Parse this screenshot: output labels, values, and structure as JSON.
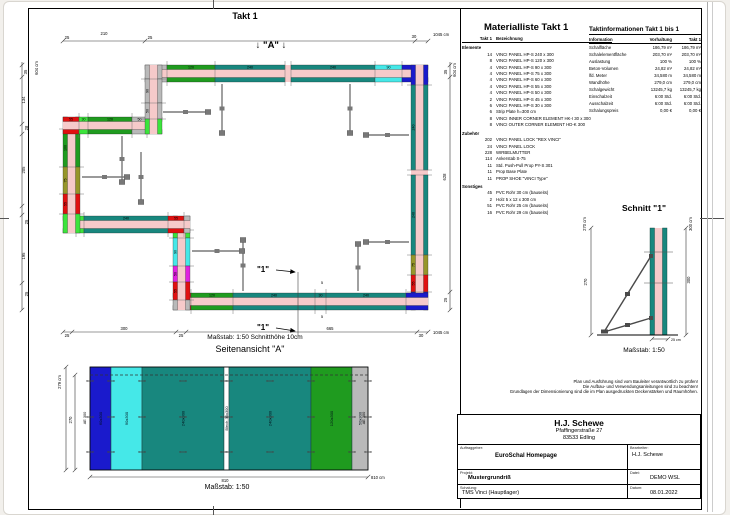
{
  "colors": {
    "teal": "#18877e",
    "green": "#1f9b1f",
    "lime": "#3ce43c",
    "cyan": "#45e8e8",
    "blue": "#1a1acc",
    "red": "#e01010",
    "magenta": "#e020e0",
    "olive": "#96962a",
    "gray": "#b9b9b9",
    "pink": "#f6caca",
    "prop": "#787878",
    "white": "#ffffff"
  },
  "plan": {
    "title": "Takt 1",
    "a_marker": "↓ \"A\" ↓",
    "scale_note": "Maßstab: 1:50   Schnitthöhe 10cm",
    "walls": [
      {
        "dir": "h",
        "x": 145,
        "y": 65,
        "len": 283,
        "segs": [
          {
            "c": "gray",
            "l": 22,
            "t": "30"
          },
          {
            "c": "green",
            "l": 48,
            "t": "120"
          },
          {
            "c": "teal",
            "l": 70,
            "t": "240"
          },
          {
            "c": "gap",
            "l": 6
          },
          {
            "c": "teal",
            "l": 84,
            "t": "240"
          },
          {
            "c": "cyan",
            "l": 27,
            "t": "90"
          },
          {
            "c": "blue",
            "l": 26
          }
        ]
      },
      {
        "dir": "v",
        "x": 411,
        "y": 65,
        "len": 245,
        "segs": [
          {
            "c": "blue",
            "l": 20
          },
          {
            "c": "teal",
            "l": 85,
            "t": "240"
          },
          {
            "c": "gap",
            "l": 5
          },
          {
            "c": "teal",
            "l": 80,
            "t": "240"
          },
          {
            "c": "olive",
            "l": 20,
            "t": "75"
          },
          {
            "c": "red",
            "l": 17,
            "t": "55"
          },
          {
            "c": "blue",
            "l": 18
          }
        ]
      },
      {
        "dir": "h",
        "x": 173,
        "y": 293,
        "len": 255,
        "segs": [
          {
            "c": "red",
            "l": 18,
            "t": "55"
          },
          {
            "c": "green",
            "l": 42,
            "t": "120"
          },
          {
            "c": "teal",
            "l": 82,
            "t": "240"
          },
          {
            "c": "teal",
            "l": 11,
            "t": "30"
          },
          {
            "c": "teal",
            "l": 80,
            "t": "240"
          },
          {
            "c": "blue",
            "l": 22
          }
        ]
      },
      {
        "dir": "v",
        "x": 173,
        "y": 216,
        "len": 94,
        "segs": [
          {
            "c": "red",
            "l": 14,
            "t": "55"
          },
          {
            "c": "lime",
            "l": 8
          },
          {
            "c": "cyan",
            "l": 28,
            "t": "90"
          },
          {
            "c": "magenta",
            "l": 16,
            "t": "50"
          },
          {
            "c": "red",
            "l": 18,
            "t": "55"
          },
          {
            "c": "gray",
            "l": 10
          }
        ]
      },
      {
        "dir": "h",
        "x": 63,
        "y": 216,
        "len": 127,
        "segs": [
          {
            "c": "red",
            "l": 13,
            "t": "55"
          },
          {
            "c": "lime",
            "l": 8
          },
          {
            "c": "teal",
            "l": 84,
            "t": "240"
          },
          {
            "c": "red",
            "l": 16,
            "t": "55"
          },
          {
            "c": "gray",
            "l": 6
          }
        ]
      },
      {
        "dir": "v",
        "x": 63,
        "y": 117,
        "len": 116,
        "segs": [
          {
            "c": "gray",
            "l": 12
          },
          {
            "c": "green",
            "l": 38,
            "t": "100"
          },
          {
            "c": "olive",
            "l": 27,
            "t": "75"
          },
          {
            "c": "red",
            "l": 20,
            "t": "55"
          },
          {
            "c": "lime",
            "l": 19
          }
        ]
      },
      {
        "dir": "h",
        "x": 63,
        "y": 117,
        "len": 99,
        "segs": [
          {
            "c": "red",
            "l": 16,
            "t": "55"
          },
          {
            "c": "lime",
            "l": 9,
            "t": "30"
          },
          {
            "c": "green",
            "l": 44,
            "t": "120"
          },
          {
            "c": "gray",
            "l": 15,
            "t": "50"
          },
          {
            "c": "gray",
            "l": 15
          }
        ]
      },
      {
        "dir": "v",
        "x": 145,
        "y": 65,
        "len": 69,
        "segs": [
          {
            "c": "gray",
            "l": 14
          },
          {
            "c": "gray",
            "l": 24,
            "t": "90"
          },
          {
            "c": "gray",
            "l": 16,
            "t": "50"
          },
          {
            "c": "lime",
            "l": 15
          }
        ]
      }
    ],
    "props": [
      {
        "x1": 222,
        "y1": 84,
        "x2": 222,
        "y2": 133
      },
      {
        "x1": 163,
        "y1": 112,
        "x2": 208,
        "y2": 112
      },
      {
        "x1": 350,
        "y1": 84,
        "x2": 350,
        "y2": 133
      },
      {
        "x1": 409,
        "y1": 135,
        "x2": 366,
        "y2": 135
      },
      {
        "x1": 82,
        "y1": 177,
        "x2": 127,
        "y2": 177
      },
      {
        "x1": 122,
        "y1": 136,
        "x2": 122,
        "y2": 182
      },
      {
        "x1": 141,
        "y1": 152,
        "x2": 141,
        "y2": 202
      },
      {
        "x1": 243,
        "y1": 291,
        "x2": 243,
        "y2": 240
      },
      {
        "x1": 192,
        "y1": 251,
        "x2": 242,
        "y2": 251
      },
      {
        "x1": 358,
        "y1": 291,
        "x2": 358,
        "y2": 244
      },
      {
        "x1": 409,
        "y1": 242,
        "x2": 366,
        "y2": 242
      }
    ],
    "texts": [
      {
        "x": 263,
        "y": 272,
        "t": "\"1\"",
        "s": 8,
        "b": 1
      },
      {
        "x": 263,
        "y": 330,
        "t": "\"1\"",
        "s": 8,
        "b": 1
      },
      {
        "x": 322,
        "y": 284,
        "t": "5",
        "s": 4
      },
      {
        "x": 322,
        "y": 318,
        "t": "5",
        "s": 4
      }
    ],
    "arrows": [
      {
        "x1": 276,
        "y1": 270,
        "x2": 295,
        "y2": 272
      },
      {
        "x1": 276,
        "y1": 328,
        "x2": 295,
        "y2": 331
      }
    ],
    "lines": [
      {
        "x1": 298,
        "y1": 272,
        "x2": 298,
        "y2": 336
      }
    ]
  },
  "dims": [
    {
      "l": [
        63,
        41,
        428,
        41
      ],
      "ticks": [
        [
          63,
          41
        ],
        [
          145,
          41
        ],
        [
          415,
          41
        ],
        [
          428,
          41
        ]
      ],
      "labels": [
        {
          "x": 67,
          "y": 39,
          "t": "25"
        },
        {
          "x": 104,
          "y": 35,
          "t": "210"
        },
        {
          "x": 150,
          "y": 39,
          "t": "25"
        },
        {
          "x": 414,
          "y": 38,
          "t": "30"
        },
        {
          "x": 433,
          "y": 36,
          "t": "1045 cm",
          "a": "start"
        }
      ]
    },
    {
      "l": [
        22,
        62,
        22,
        310
      ],
      "ticks": [
        [
          22,
          65
        ],
        [
          22,
          77
        ],
        [
          22,
          124
        ],
        [
          22,
          134
        ],
        [
          22,
          206
        ],
        [
          22,
          215
        ],
        [
          22,
          283
        ],
        [
          22,
          310
        ]
      ],
      "labels": [
        {
          "x": 38,
          "y": 68,
          "t": "604 cm",
          "r": 1
        },
        {
          "x": 27,
          "y": 72,
          "t": "35",
          "r": 1
        },
        {
          "x": 25,
          "y": 100,
          "t": "134",
          "r": 1
        },
        {
          "x": 28,
          "y": 128,
          "t": "28",
          "r": 1
        },
        {
          "x": 25,
          "y": 170,
          "t": "205",
          "r": 1
        },
        {
          "x": 28,
          "y": 222,
          "t": "25",
          "r": 1
        },
        {
          "x": 25,
          "y": 256,
          "t": "195",
          "r": 1
        },
        {
          "x": 28,
          "y": 294,
          "t": "25",
          "r": 1
        }
      ]
    },
    {
      "l": [
        450,
        62,
        450,
        310
      ],
      "ticks": [
        [
          450,
          65
        ],
        [
          450,
          77
        ],
        [
          450,
          292
        ],
        [
          450,
          310
        ]
      ],
      "labels": [
        {
          "x": 456,
          "y": 70,
          "t": "604 cm",
          "r": 1
        },
        {
          "x": 447,
          "y": 72,
          "t": "35",
          "r": 1
        },
        {
          "x": 446,
          "y": 177,
          "t": "628",
          "r": 1
        },
        {
          "x": 447,
          "y": 300,
          "t": "25",
          "r": 1
        }
      ]
    },
    {
      "l": [
        63,
        332,
        428,
        332
      ],
      "ticks": [
        [
          63,
          332
        ],
        [
          72,
          332
        ],
        [
          176,
          332
        ],
        [
          186,
          332
        ],
        [
          417,
          332
        ],
        [
          428,
          332
        ]
      ],
      "labels": [
        {
          "x": 67,
          "y": 337,
          "t": "25"
        },
        {
          "x": 124,
          "y": 330,
          "t": "300"
        },
        {
          "x": 181,
          "y": 337,
          "t": "25"
        },
        {
          "x": 330,
          "y": 330,
          "t": "665"
        },
        {
          "x": 421,
          "y": 337,
          "t": "30"
        },
        {
          "x": 433,
          "y": 334,
          "t": "1045 cm",
          "a": "start"
        }
      ]
    },
    {
      "l": [
        66,
        367,
        66,
        470
      ],
      "ticks": [
        [
          66,
          367
        ],
        [
          66,
          470
        ]
      ],
      "labels": [
        {
          "x": 61,
          "y": 382,
          "t": "279 cm",
          "r": 1
        }
      ]
    },
    {
      "l": [
        75,
        375,
        75,
        470
      ],
      "ticks": [
        [
          75,
          375
        ],
        [
          75,
          470
        ]
      ],
      "labels": [
        {
          "x": 72,
          "y": 420,
          "t": "270",
          "r": 1
        }
      ]
    },
    {
      "l": [
        90,
        477,
        368,
        477
      ],
      "ticks": [
        [
          90,
          477
        ],
        [
          368,
          477
        ]
      ],
      "labels": [
        {
          "x": 225,
          "y": 482,
          "t": "810"
        },
        {
          "x": 371,
          "y": 479,
          "t": "810 cm",
          "a": "start"
        }
      ]
    },
    {
      "l": [
        591,
        228,
        591,
        335
      ],
      "ticks": [
        [
          591,
          228
        ],
        [
          591,
          335
        ]
      ],
      "labels": [
        {
          "x": 586,
          "y": 224,
          "t": "270 cm",
          "r": 1
        },
        {
          "x": 587,
          "y": 282,
          "t": "270",
          "r": 1
        }
      ]
    },
    {
      "l": [
        686,
        228,
        686,
        335
      ],
      "ticks": [
        [
          686,
          228
        ],
        [
          686,
          335
        ]
      ],
      "labels": [
        {
          "x": 692,
          "y": 224,
          "t": "300 cm",
          "r": 1
        },
        {
          "x": 690,
          "y": 280,
          "t": "300",
          "r": 1
        }
      ]
    },
    {
      "l": [
        652,
        339,
        668,
        339
      ],
      "ticks": [
        [
          652,
          339
        ],
        [
          668,
          339
        ]
      ],
      "labels": [
        {
          "x": 671,
          "y": 341,
          "t": "25 cm",
          "a": "start",
          "s": 3.6
        }
      ]
    }
  ],
  "side_view": {
    "title": "Seitenansicht \"A\"",
    "scale": "Maßstab: 1:50",
    "x": 90,
    "y": 367,
    "h": 103,
    "dash_y": 375,
    "tie_rows": [
      381,
      417,
      452
    ],
    "panels": [
      {
        "w": 21,
        "c": "blue",
        "label": "60x300"
      },
      {
        "w": 31,
        "c": "cyan",
        "label": "90x300"
      },
      {
        "w": 82,
        "c": "teal",
        "label": "240x300"
      },
      {
        "w": 5,
        "c": "white",
        "label": "Blech 30x300"
      },
      {
        "w": 82,
        "c": "teal",
        "label": "240x300"
      },
      {
        "w": 41,
        "c": "green",
        "label": "120x300"
      },
      {
        "w": 16,
        "c": "gray",
        "label": "50x300"
      }
    ],
    "edge_labels": [
      {
        "x": 86,
        "y": 418,
        "t": "AE 300"
      },
      {
        "x": 365,
        "y": 418,
        "t": "AE 300"
      }
    ]
  },
  "schnitt": {
    "title": "Schnitt \"1\"",
    "scale": "Maßstab: 1:50",
    "wall": {
      "x": 650,
      "y": 228,
      "h": 107,
      "panel_w": 4.5,
      "core_w": 8
    },
    "ties_y": [
      252,
      283
    ],
    "ground": {
      "x1": 597,
      "y1": 335,
      "x2": 678,
      "y2": 335
    },
    "props": [
      {
        "x1": 651,
        "y1": 256,
        "x2": 604,
        "y2": 332
      },
      {
        "x1": 651,
        "y1": 318,
        "x2": 604,
        "y2": 332
      }
    ]
  },
  "material_list": {
    "title": "Materialliste  Takt 1",
    "col_qty": "Takt 1",
    "col_name": "Bezeichnung",
    "sections": [
      {
        "name": "Elemente",
        "items": [
          {
            "qty": "14",
            "name": "VINCI PANEL HP-S 240 x 300"
          },
          {
            "qty": "8",
            "name": "VINCI PANEL HP-S 120 x 300"
          },
          {
            "qty": "4",
            "name": "VINCI PANEL HP-S 90 x 300"
          },
          {
            "qty": "4",
            "name": "VINCI PANEL HP-S 75 x 300"
          },
          {
            "qty": "4",
            "name": "VINCI PANEL HP-S 60 x 300"
          },
          {
            "qty": "4",
            "name": "VINCI PANEL HP-S 55 x 300"
          },
          {
            "qty": "4",
            "name": "VINCI PANEL HP-S 50 x 300"
          },
          {
            "qty": "2",
            "name": "VINCI PANEL HP-S 45 x 300"
          },
          {
            "qty": "6",
            "name": "VINCI PANEL HP-S 30 x 300"
          },
          {
            "qty": "6",
            "name": "Strip Plate h=300 cm"
          },
          {
            "qty": "8",
            "name": "VINCI INNER CORNER ELEMENT HK-I 30 x 300"
          },
          {
            "qty": "8",
            "name": "VINCI OUTER CORNER ELEMENT HD-K 300"
          }
        ]
      },
      {
        "name": "Zubehör",
        "items": [
          {
            "qty": "202",
            "name": "VINCI PANEL LOCK \"REX VINCI\""
          },
          {
            "qty": "24",
            "name": "VINCI PANEL LOCK"
          },
          {
            "qty": "228",
            "name": "WIRBELMUTTER"
          },
          {
            "qty": "114",
            "name": "Ankerstab S-75"
          },
          {
            "qty": "11",
            "name": "Std. Push-Pull Prop PY-S 301"
          },
          {
            "qty": "11",
            "name": "Prop Base Plate"
          },
          {
            "qty": "11",
            "name": "PROP SHOE \"VINCI Type\""
          }
        ]
      },
      {
        "name": "Sonstiges",
        "items": [
          {
            "qty": "45",
            "name": "PVC Rohr 30 cm (bauseits)"
          },
          {
            "qty": "2",
            "name": "Holz 5 x 12 x 300 cm"
          },
          {
            "qty": "51",
            "name": "PVC Rohr 25 cm (bauseits)"
          },
          {
            "qty": "16",
            "name": "PVC Rohr 29 cm (bauseits)"
          }
        ]
      }
    ]
  },
  "takt_info": {
    "title": "Taktinformationen  Takt 1 bis 1",
    "columns": [
      "Information",
      "Vorhaltung",
      "Takt 1"
    ],
    "rows": [
      [
        "Schalfläche",
        "186,79 m²",
        "186,79 m²"
      ],
      [
        "Schalelementfläche",
        "203,70 m²",
        "203,70 m²"
      ],
      [
        "Auslastung",
        "100 %",
        "100 %"
      ],
      [
        "Beton-Volumen",
        "24,82 m³",
        "24,82 m³"
      ],
      [
        "lfd. Meter",
        "34,580 m",
        "34,580 m"
      ],
      [
        "Wandhöhe",
        "279,0 cm",
        "279,0 cm"
      ],
      [
        "Schalgewicht",
        "13245,7 kg",
        "13245,7 kg"
      ],
      [
        "Einschalzeit",
        "6:00 Std.",
        "6:00 Std."
      ],
      [
        "Ausschalzeit",
        "6:00 Std.",
        "6:00 Std."
      ],
      [
        "Schalungspreis",
        "0,00 €",
        "0,00 €"
      ]
    ]
  },
  "disclaimer_lines": [
    "Plan und Ausführung sind vom Bauleiter verantwortlich zu prüfen!",
    "Die Aufbau- und Verwendungsanleitungen sind zu beachten!",
    "Grundlagen der Dimensionierung sind die im Plan ausgedruckten Deckenstärken und Raumhöhen."
  ],
  "title_block": {
    "company": "H.J. Schewe",
    "street": "Pfaffingerstraße 27",
    "city": "83533 Edling",
    "auftraggeber_label": "Auftraggeber:",
    "auftraggeber": "EuroSchal Homepage",
    "bearbeiter_label": "Bearbeiter:",
    "bearbeiter": "H.J. Schewe",
    "projekt_label": "Projekt:",
    "projekt": "Mustergrundriß",
    "datei_label": "Datei:",
    "datei": "DEMO WSL",
    "schalung_label": "Schalung:",
    "schalung": "TMS Vinci (Hauptlager)",
    "datum_label": "Datum:",
    "datum": "08.01.2022"
  }
}
